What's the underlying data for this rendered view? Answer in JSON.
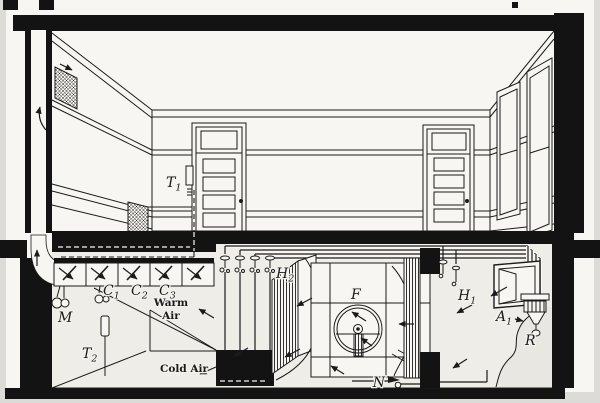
{
  "figure": {
    "description_colors": {
      "ink": "#1b1b1b",
      "paper": "#f7f6f2",
      "page_bg": "#dcdbd7",
      "basement_tint": "#efede7",
      "earth_wash": "#e9e7e1"
    }
  },
  "labels": {
    "thermostat_room": {
      "main": "T",
      "sub": "1"
    },
    "thermostat_basement": {
      "main": "T",
      "sub": "2"
    },
    "damper_c1": {
      "main": "C",
      "sub": "1"
    },
    "damper_c2": {
      "main": "C",
      "sub": "2"
    },
    "damper_c3": {
      "main": "C",
      "sub": "3"
    },
    "motor": "M",
    "warm_air": {
      "line1": "Warm",
      "line2": "Air"
    },
    "cold_air": "Cold Air",
    "heater_main": {
      "main": "H",
      "sub": "2"
    },
    "fan": "F",
    "trap": "N",
    "heater_tempering": {
      "main": "H",
      "sub": "1"
    },
    "air_inlet": {
      "main": "A",
      "sub": "1"
    },
    "regulator": "R"
  }
}
